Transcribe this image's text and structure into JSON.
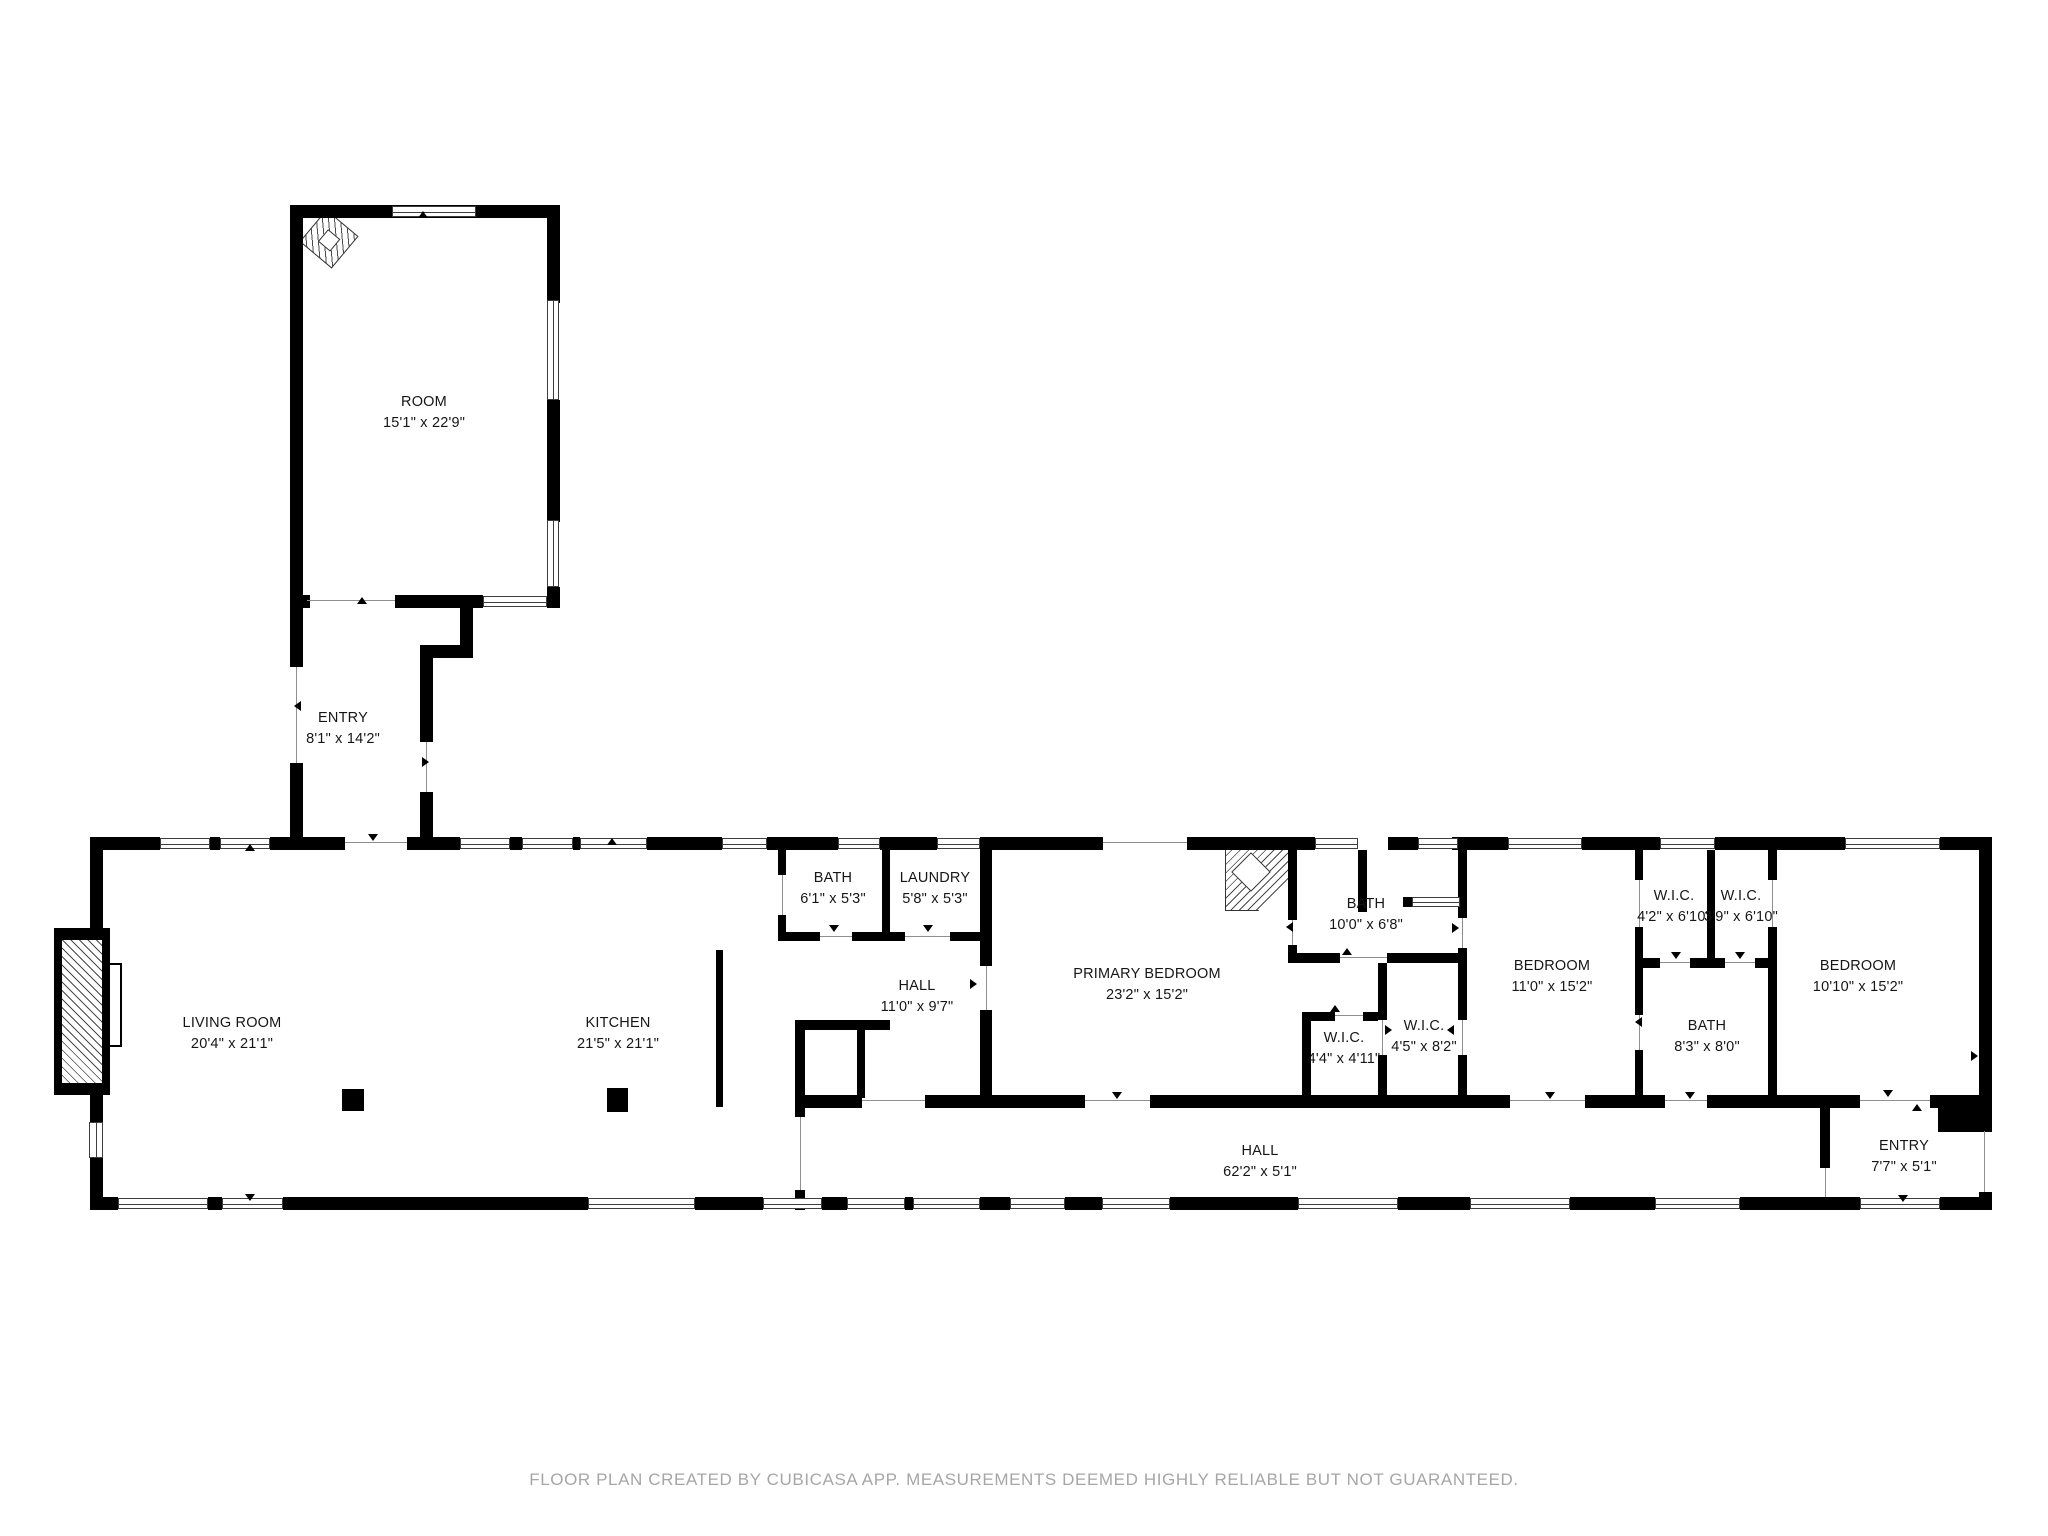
{
  "title": "Floor plan",
  "colors": {
    "wall": "#000000",
    "door_line": "#8f8f8f",
    "label": "#161616",
    "footer": "#a6a6a6",
    "background": "#ffffff"
  },
  "footer": {
    "text": "FLOOR PLAN CREATED BY CUBICASA APP. MEASUREMENTS DEEMED HIGHLY RELIABLE BUT NOT GUARANTEED."
  },
  "rooms": [
    {
      "slug": "room",
      "name": "ROOM",
      "dims": "15'1\" x 22'9\"",
      "cx": 424,
      "top": 392
    },
    {
      "slug": "entry-upper",
      "name": "ENTRY",
      "dims": "8'1\" x 14'2\"",
      "cx": 343,
      "top": 708
    },
    {
      "slug": "living-room",
      "name": "LIVING ROOM",
      "dims": "20'4\" x 21'1\"",
      "cx": 232,
      "top": 1013
    },
    {
      "slug": "kitchen",
      "name": "KITCHEN",
      "dims": "21'5\" x 21'1\"",
      "cx": 618,
      "top": 1013
    },
    {
      "slug": "bath-1",
      "name": "BATH",
      "dims": "6'1\" x 5'3\"",
      "cx": 833,
      "top": 868
    },
    {
      "slug": "laundry",
      "name": "LAUNDRY",
      "dims": "5'8\" x 5'3\"",
      "cx": 935,
      "top": 868
    },
    {
      "slug": "hall-room",
      "name": "HALL",
      "dims": "11'0\" x 9'7\"",
      "cx": 917,
      "top": 976
    },
    {
      "slug": "primary-bedroom",
      "name": "PRIMARY BEDROOM",
      "dims": "23'2\" x 15'2\"",
      "cx": 1147,
      "top": 964
    },
    {
      "slug": "primary-bath",
      "name": "BATH",
      "dims": "10'0\" x 6'8\"",
      "cx": 1366,
      "top": 894
    },
    {
      "slug": "wic-1",
      "name": "W.I.C.",
      "dims": "4'4\" x 4'11\"",
      "cx": 1344,
      "top": 1028
    },
    {
      "slug": "wic-2",
      "name": "W.I.C.",
      "dims": "4'5\" x 8'2\"",
      "cx": 1424,
      "top": 1016
    },
    {
      "slug": "bedroom-1",
      "name": "BEDROOM",
      "dims": "11'0\" x 15'2\"",
      "cx": 1552,
      "top": 956
    },
    {
      "slug": "wic-3",
      "name": "W.I.C.",
      "dims": "4'2\" x 6'10\"",
      "cx": 1674,
      "top": 886
    },
    {
      "slug": "wic-4",
      "name": "W.I.C.",
      "dims": "3'9\" x 6'10\"",
      "cx": 1741,
      "top": 886
    },
    {
      "slug": "bath-2",
      "name": "BATH",
      "dims": "8'3\" x 8'0\"",
      "cx": 1707,
      "top": 1016
    },
    {
      "slug": "bedroom-2",
      "name": "BEDROOM",
      "dims": "10'10\" x 15'2\"",
      "cx": 1858,
      "top": 956
    },
    {
      "slug": "entry-lower",
      "name": "ENTRY",
      "dims": "7'7\" x 5'1\"",
      "cx": 1904,
      "top": 1136
    },
    {
      "slug": "hall-corridor",
      "name": "HALL",
      "dims": "62'2\" x 5'1\"",
      "cx": 1260,
      "top": 1141
    }
  ],
  "geometry": {
    "walls": [
      [
        290,
        205,
        270,
        13
      ],
      [
        290,
        205,
        13,
        462
      ],
      [
        290,
        763,
        13,
        82
      ],
      [
        547,
        205,
        13,
        98
      ],
      [
        547,
        400,
        13,
        122
      ],
      [
        547,
        587,
        13,
        21
      ],
      [
        432,
        205,
        4,
        13
      ],
      [
        290,
        595,
        20,
        13
      ],
      [
        395,
        595,
        88,
        13
      ],
      [
        547,
        595,
        13,
        13
      ],
      [
        460,
        603,
        13,
        55
      ],
      [
        420,
        645,
        53,
        13
      ],
      [
        420,
        658,
        13,
        84
      ],
      [
        420,
        792,
        13,
        53
      ],
      [
        90,
        837,
        70,
        13
      ],
      [
        210,
        837,
        10,
        13
      ],
      [
        270,
        837,
        75,
        13
      ],
      [
        407,
        837,
        53,
        13
      ],
      [
        510,
        837,
        12,
        13
      ],
      [
        573,
        837,
        7,
        13
      ],
      [
        647,
        837,
        75,
        13
      ],
      [
        767,
        837,
        19,
        13
      ],
      [
        786,
        837,
        52,
        13
      ],
      [
        880,
        837,
        57,
        13
      ],
      [
        980,
        837,
        123,
        13
      ],
      [
        1187,
        837,
        128,
        13
      ],
      [
        1388,
        837,
        30,
        13
      ],
      [
        1452,
        837,
        56,
        13
      ],
      [
        1582,
        837,
        78,
        13
      ],
      [
        1715,
        837,
        130,
        13
      ],
      [
        1940,
        837,
        52,
        13
      ],
      [
        90,
        1197,
        28,
        13
      ],
      [
        208,
        1197,
        14,
        13
      ],
      [
        283,
        1197,
        305,
        13
      ],
      [
        695,
        1197,
        68,
        13
      ],
      [
        822,
        1197,
        25,
        13
      ],
      [
        905,
        1197,
        8,
        13
      ],
      [
        980,
        1197,
        30,
        13
      ],
      [
        1065,
        1197,
        37,
        13
      ],
      [
        1170,
        1197,
        128,
        13
      ],
      [
        1398,
        1197,
        72,
        13
      ],
      [
        1570,
        1197,
        85,
        13
      ],
      [
        1740,
        1197,
        120,
        13
      ],
      [
        1940,
        1197,
        52,
        13
      ],
      [
        90,
        837,
        13,
        285
      ],
      [
        90,
        1158,
        13,
        52
      ],
      [
        54,
        928,
        56,
        167
      ],
      [
        1979,
        837,
        13,
        294
      ],
      [
        1979,
        1192,
        13,
        18
      ],
      [
        778,
        850,
        8,
        25
      ],
      [
        778,
        915,
        8,
        25
      ],
      [
        882,
        850,
        8,
        90
      ],
      [
        980,
        850,
        12,
        116
      ],
      [
        980,
        1010,
        12,
        98
      ],
      [
        778,
        932,
        42,
        9
      ],
      [
        852,
        932,
        53,
        9
      ],
      [
        950,
        932,
        30,
        9
      ],
      [
        716,
        950,
        7,
        157
      ],
      [
        795,
        1020,
        95,
        10
      ],
      [
        795,
        1020,
        10,
        97
      ],
      [
        795,
        1190,
        10,
        20
      ],
      [
        857,
        1030,
        8,
        68
      ],
      [
        805,
        1095,
        57,
        13
      ],
      [
        925,
        1095,
        160,
        13
      ],
      [
        1150,
        1095,
        360,
        13
      ],
      [
        1585,
        1095,
        80,
        13
      ],
      [
        1707,
        1095,
        153,
        13
      ],
      [
        1930,
        1095,
        62,
        13
      ],
      [
        1938,
        1095,
        54,
        37
      ],
      [
        1820,
        1108,
        10,
        60
      ],
      [
        1358,
        850,
        9,
        62
      ],
      [
        1403,
        897,
        9,
        10
      ],
      [
        1288,
        850,
        9,
        70
      ],
      [
        1288,
        945,
        9,
        18
      ],
      [
        1288,
        953,
        52,
        10
      ],
      [
        1387,
        953,
        78,
        10
      ],
      [
        1458,
        850,
        9,
        68
      ],
      [
        1458,
        948,
        9,
        72
      ],
      [
        1458,
        1055,
        9,
        53
      ],
      [
        1302,
        1012,
        33,
        9
      ],
      [
        1363,
        1012,
        15,
        9
      ],
      [
        1302,
        1012,
        9,
        96
      ],
      [
        1378,
        963,
        9,
        57
      ],
      [
        1378,
        1055,
        9,
        53
      ],
      [
        1635,
        850,
        8,
        30
      ],
      [
        1635,
        927,
        8,
        88
      ],
      [
        1635,
        1050,
        8,
        58
      ],
      [
        1707,
        850,
        8,
        118
      ],
      [
        1643,
        958,
        17,
        10
      ],
      [
        1690,
        958,
        35,
        10
      ],
      [
        1755,
        958,
        22,
        10
      ],
      [
        1768,
        850,
        9,
        30
      ],
      [
        1768,
        927,
        9,
        181
      ]
    ],
    "hatch_rects": [
      [
        62,
        940,
        40,
        143
      ]
    ],
    "windows_h": [
      [
        392,
        206,
        84,
        11
      ],
      [
        483,
        596,
        64,
        11
      ],
      [
        160,
        838,
        50,
        11
      ],
      [
        220,
        838,
        50,
        11
      ],
      [
        460,
        838,
        50,
        11
      ],
      [
        522,
        838,
        51,
        11
      ],
      [
        580,
        838,
        67,
        11
      ],
      [
        722,
        838,
        45,
        11
      ],
      [
        838,
        838,
        42,
        11
      ],
      [
        937,
        838,
        43,
        11
      ],
      [
        1315,
        838,
        43,
        11
      ],
      [
        1418,
        838,
        40,
        11
      ],
      [
        1508,
        838,
        74,
        11
      ],
      [
        1660,
        838,
        55,
        11
      ],
      [
        1845,
        838,
        95,
        11
      ],
      [
        118,
        1198,
        90,
        11
      ],
      [
        222,
        1198,
        61,
        11
      ],
      [
        588,
        1198,
        107,
        11
      ],
      [
        763,
        1198,
        59,
        11
      ],
      [
        847,
        1198,
        58,
        11
      ],
      [
        913,
        1198,
        67,
        11
      ],
      [
        1010,
        1198,
        55,
        11
      ],
      [
        1102,
        1198,
        68,
        11
      ],
      [
        1298,
        1198,
        100,
        11
      ],
      [
        1470,
        1198,
        100,
        11
      ],
      [
        1655,
        1198,
        85,
        11
      ],
      [
        1860,
        1198,
        80,
        11
      ],
      [
        1412,
        897,
        48,
        10
      ]
    ],
    "windows_v": [
      [
        547,
        300,
        12,
        100
      ],
      [
        547,
        520,
        12,
        67
      ],
      [
        89,
        1122,
        14,
        36
      ]
    ],
    "door_lines_h": [
      [
        307,
        600,
        88
      ],
      [
        345,
        842,
        62
      ],
      [
        1103,
        842,
        84
      ],
      [
        820,
        936,
        32
      ],
      [
        905,
        936,
        45
      ],
      [
        862,
        1100,
        63
      ],
      [
        1085,
        1100,
        65
      ],
      [
        1510,
        1100,
        75
      ],
      [
        1665,
        1100,
        42
      ],
      [
        1860,
        1100,
        70
      ],
      [
        1340,
        957,
        47
      ],
      [
        1335,
        1015,
        28
      ],
      [
        1660,
        962,
        30
      ],
      [
        1725,
        962,
        30
      ]
    ],
    "door_lines_v": [
      [
        296,
        667,
        96
      ],
      [
        426,
        742,
        50
      ],
      [
        986,
        966,
        44
      ],
      [
        782,
        875,
        40
      ],
      [
        800,
        1117,
        73
      ],
      [
        1292,
        920,
        25
      ],
      [
        1462,
        918,
        30
      ],
      [
        1382,
        1020,
        35
      ],
      [
        1462,
        1020,
        35
      ],
      [
        1639,
        880,
        47
      ],
      [
        1772,
        880,
        47
      ],
      [
        1639,
        1015,
        35
      ],
      [
        1825,
        1168,
        29
      ],
      [
        1984,
        1131,
        61
      ]
    ],
    "posts": [
      [
        342,
        1089,
        22,
        22
      ],
      [
        607,
        1088,
        21,
        24
      ]
    ],
    "markers": [
      [
        423,
        216,
        "up"
      ],
      [
        250,
        849,
        "up"
      ],
      [
        362,
        602,
        "up"
      ],
      [
        373,
        839,
        "down"
      ],
      [
        612,
        843,
        "up"
      ],
      [
        834,
        930,
        "down"
      ],
      [
        928,
        930,
        "down"
      ],
      [
        250,
        1199,
        "down"
      ],
      [
        975,
        984,
        "right"
      ],
      [
        1117,
        1097,
        "down"
      ],
      [
        1291,
        927,
        "left"
      ],
      [
        1457,
        928,
        "right"
      ],
      [
        1347,
        953,
        "up"
      ],
      [
        1335,
        1010,
        "up"
      ],
      [
        1390,
        1030,
        "right"
      ],
      [
        1452,
        1030,
        "left"
      ],
      [
        1550,
        1097,
        "down"
      ],
      [
        1640,
        1022,
        "left"
      ],
      [
        1676,
        957,
        "down"
      ],
      [
        1740,
        957,
        "down"
      ],
      [
        1690,
        1097,
        "down"
      ],
      [
        1888,
        1095,
        "down"
      ],
      [
        1917,
        1109,
        "up"
      ],
      [
        1903,
        1200,
        "down"
      ],
      [
        299,
        706,
        "left"
      ],
      [
        427,
        762,
        "right"
      ],
      [
        1976,
        1056,
        "right"
      ]
    ]
  }
}
